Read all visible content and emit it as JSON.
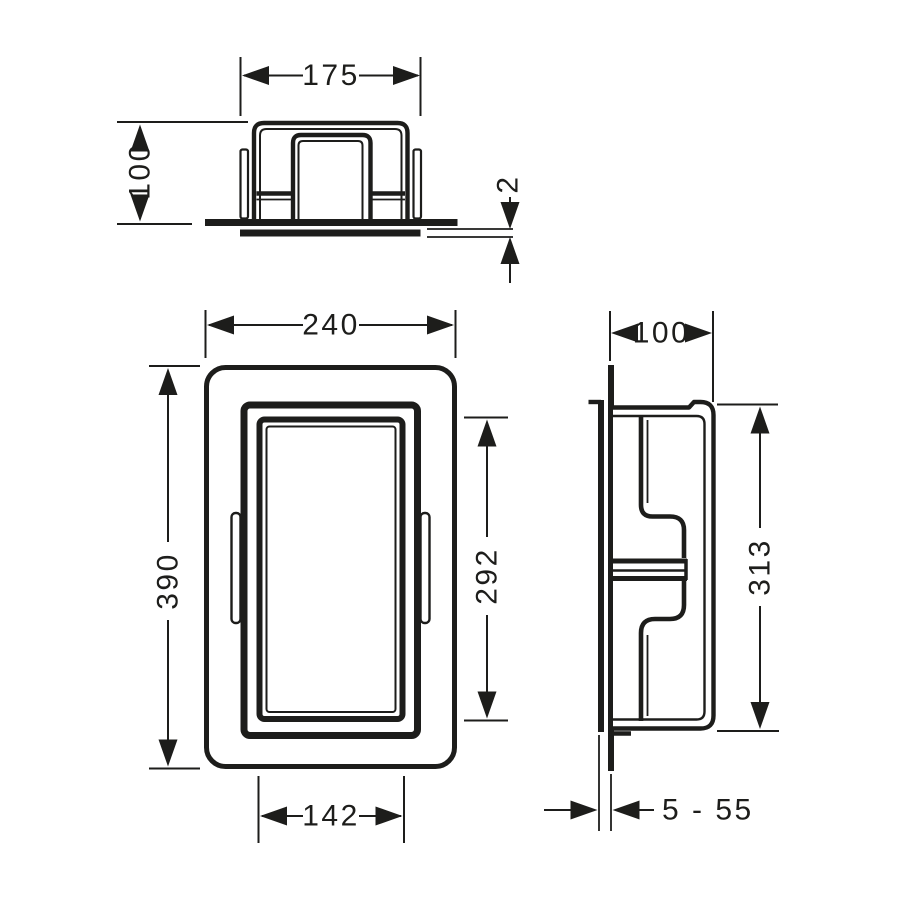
{
  "colors": {
    "line": "#1d1d1b",
    "background": "#ffffff"
  },
  "views": {
    "top": {
      "width": "175",
      "depth": "100",
      "flange_thickness": "2"
    },
    "front": {
      "width": "240",
      "height": "390",
      "opening_height": "292",
      "opening_width": "142"
    },
    "side": {
      "depth": "100",
      "body_height": "313",
      "tile_thickness_range": "5 - 55"
    }
  }
}
